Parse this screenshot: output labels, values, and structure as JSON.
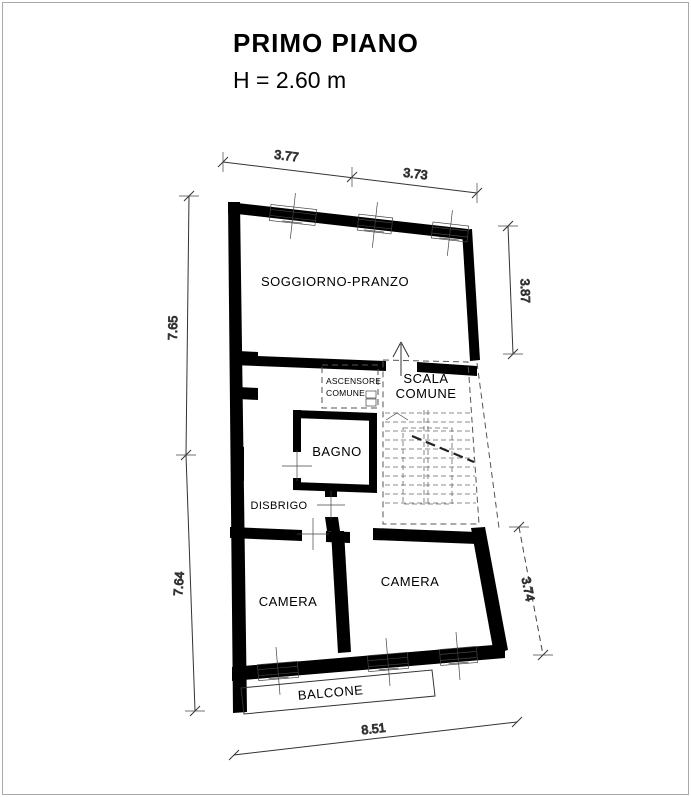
{
  "title": {
    "name": "PRIMO PIANO",
    "height": "H = 2.60 m"
  },
  "rooms": {
    "soggiorno": "SOGGIORNO-PRANZO",
    "ascensore1": "ASCENSORE",
    "ascensore2": "COMUNE",
    "scala1": "SCALA",
    "scala2": "COMUNE",
    "bagno": "BAGNO",
    "disbrigo": "DISBRIGO",
    "camera_left": "CAMERA",
    "camera_right": "CAMERA",
    "balcone": "BALCONE"
  },
  "dims": {
    "top1": "3.77",
    "top2": "3.73",
    "left1": "7.65",
    "left2": "7.64",
    "right1": "3.87",
    "right2": "3.74",
    "bottom1": "8.51"
  },
  "colors": {
    "wall": "#000000",
    "line": "#333333",
    "background": "#ffffff"
  }
}
